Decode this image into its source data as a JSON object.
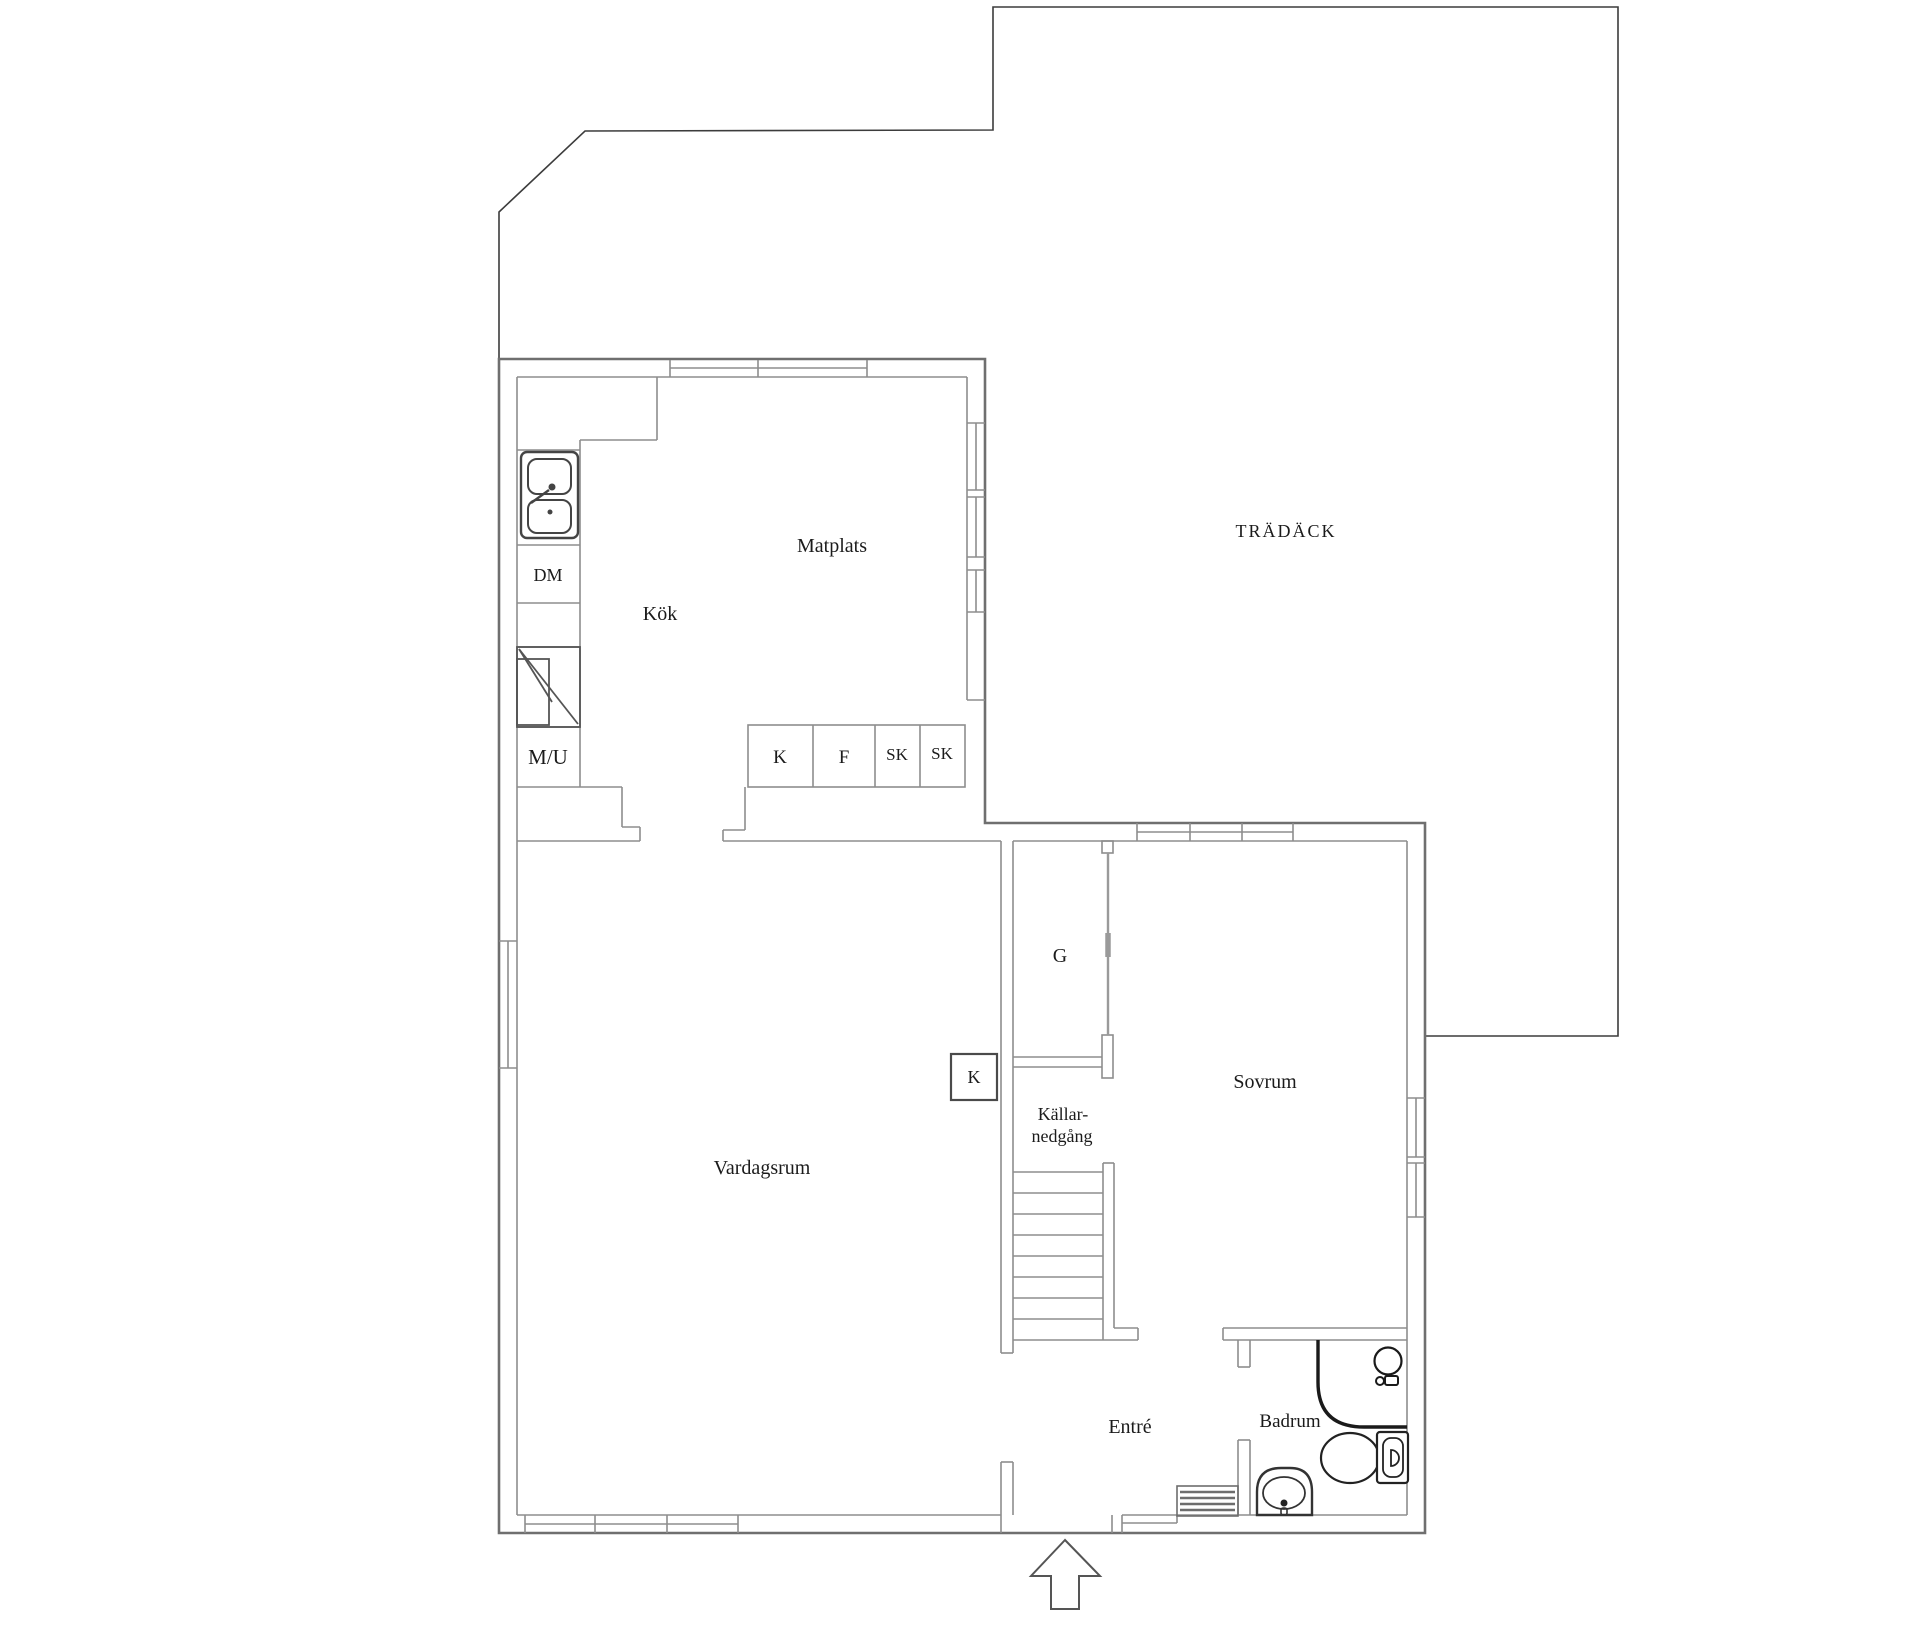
{
  "plan": {
    "title_hint": "floor plan",
    "deck": {
      "label": "TRÄDÄCK"
    },
    "rooms": {
      "dining": "Matplats",
      "kitchen": "Kök",
      "living": "Vardagsrum",
      "bedroom": "Sovrum",
      "entry": "Entré",
      "bathroom": "Badrum",
      "wardrobe": "G",
      "basement_line1": "Källar-",
      "basement_line2": "nedgång"
    },
    "kitchen_items": {
      "dishwasher": "DM",
      "micro_oven": "M/U",
      "cabinet_k": "K",
      "cabinet_f": "F",
      "cabinet_sk1": "SK",
      "cabinet_sk2": "SK"
    },
    "hall_items": {
      "closet_k": "K"
    },
    "colors": {
      "wall_outer": "#6f6f6f",
      "wall_inner": "#8d8d8d",
      "deck_line": "#3c3c3c",
      "fixture": "#222222",
      "text": "#1b1b1b"
    }
  }
}
